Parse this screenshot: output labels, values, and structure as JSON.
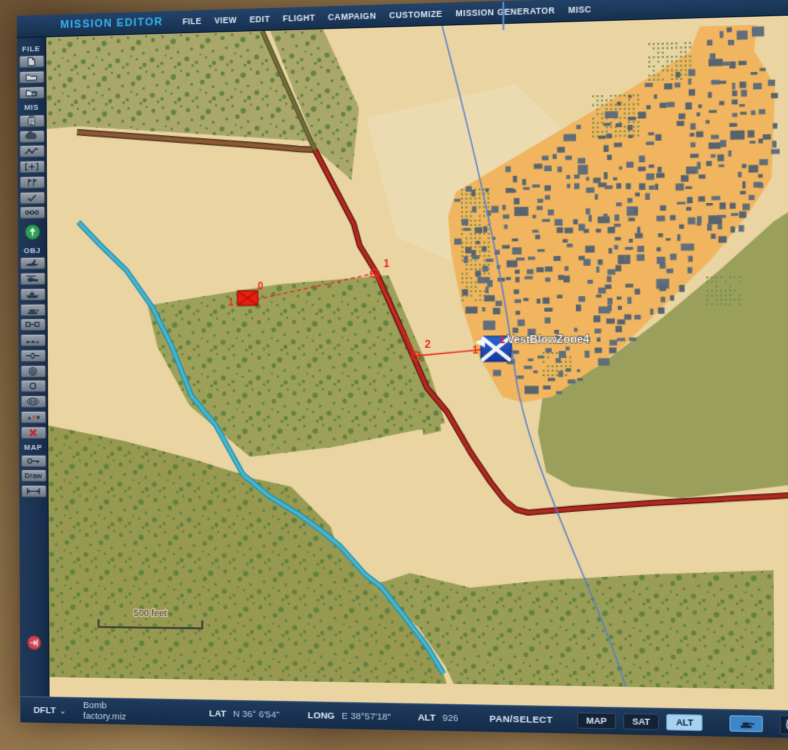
{
  "menu_bar": {
    "app_title": "MISSION EDITOR",
    "items": [
      "FILE",
      "VIEW",
      "EDIT",
      "FLIGHT",
      "CAMPAIGN",
      "CUSTOMIZE",
      "MISSION GENERATOR",
      "MISC"
    ]
  },
  "toolbar": {
    "sections": [
      {
        "label": "FILE",
        "icons": [
          "new-mission-icon",
          "open-mission-icon",
          "save-mission-icon"
        ]
      },
      {
        "label": "MIS",
        "icons": [
          "briefing-icon",
          "weather-icon",
          "routes-icon",
          "bullseye-icon",
          "flags-icon",
          "checklist-icon",
          "triggers-icon",
          "start-icon"
        ]
      },
      {
        "label": "OBJ",
        "icons": [
          "airplane-icon",
          "helicopter-icon",
          "ship-icon",
          "vehicle-icon",
          "linked-group-icon",
          "static-object-icon",
          "pipeline-icon",
          "template-icon",
          "zone-icon",
          "units-group-icon",
          "shapes-icon",
          "delete-icon"
        ]
      },
      {
        "label": "MAP",
        "icons": [
          "key-icon",
          "draw-button",
          "ruler-icon"
        ]
      }
    ],
    "draw_label": "Draw",
    "exit_icon": "exit-icon"
  },
  "map": {
    "unit_label": "1",
    "waypoint0_label": "0",
    "waypoint1_label": "1",
    "waypoint2_label": "2",
    "static_number": "1",
    "static_name_number": "1",
    "static_name": "VestBlowZone4",
    "scale_label": "500 feet"
  },
  "status_bar": {
    "theme": "DFLT",
    "chevron_icon": "chevron-down-icon",
    "mission_file": "Bomb factory.miz",
    "lat_label": "LAT",
    "lat_value": "N 36° 6'54\"",
    "long_label": "LONG",
    "long_value": "E 38°57'18\"",
    "alt_label": "ALT",
    "alt_value": "926",
    "mode": "PAN/SELECT",
    "map_button": "MAP",
    "sat_button": "SAT",
    "alt_button": "ALT",
    "right_icons": [
      "tank-icon",
      "clock-icon"
    ]
  },
  "colors": {
    "bar_bg": "#1d3452",
    "accent_cyan": "#35b4f0",
    "map_tan": "#e9d4a2",
    "olive_base": "#a0a05e",
    "speck_green": "#5d7f40",
    "city_orange": "#f0b55e",
    "building_gray": "#57636f",
    "road_red": "#b3291f",
    "river_teal": "#35aac4",
    "route_red": "#e8281c",
    "line_blue": "#4d7ecf",
    "alt_active_bg": "#a5d2f0"
  }
}
